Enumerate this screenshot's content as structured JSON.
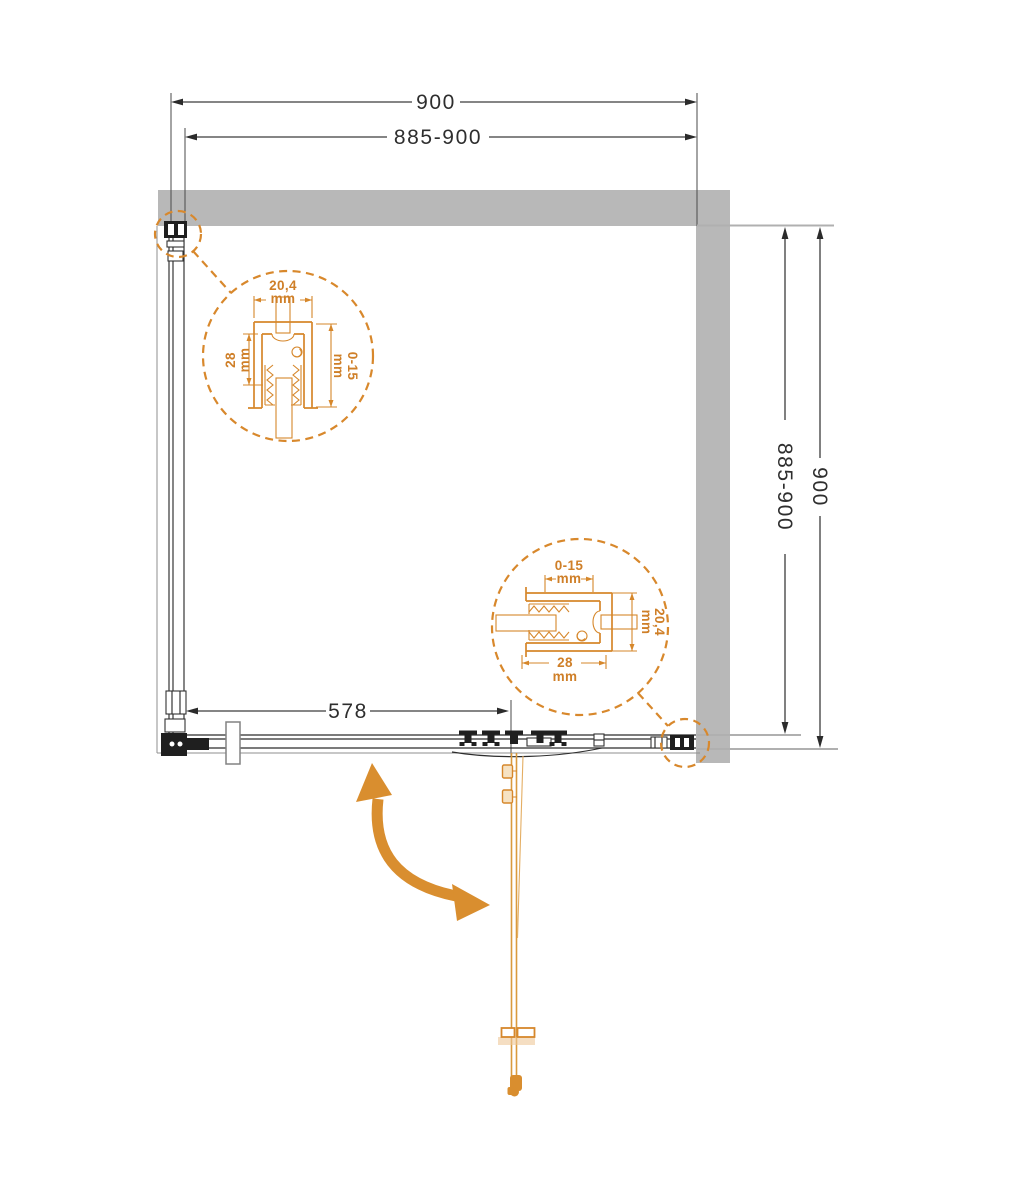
{
  "diagram": {
    "type": "shower-enclosure-installation-top-view",
    "dims": {
      "top_outer": "900",
      "top_inner": "885-900",
      "side_inner": "885-900",
      "side_outer": "900",
      "door_width": "578"
    },
    "detail_top_left": {
      "profile_width": "20,4",
      "profile_width_unit": "mm",
      "profile_depth": "28",
      "profile_depth_unit": "mm",
      "adjustment": "0-15",
      "adjustment_unit": "mm"
    },
    "detail_bottom_right": {
      "adjustment": "0-15",
      "adjustment_unit": "mm",
      "profile_width": "20,4",
      "profile_width_unit": "mm",
      "profile_depth": "28",
      "profile_depth_unit": "mm"
    },
    "colors": {
      "wall_gray": "#b8b8b8",
      "drawing_line": "#2e2e2e",
      "accent_orange": "#d6872b",
      "door_orange": "#d99a3e"
    }
  }
}
